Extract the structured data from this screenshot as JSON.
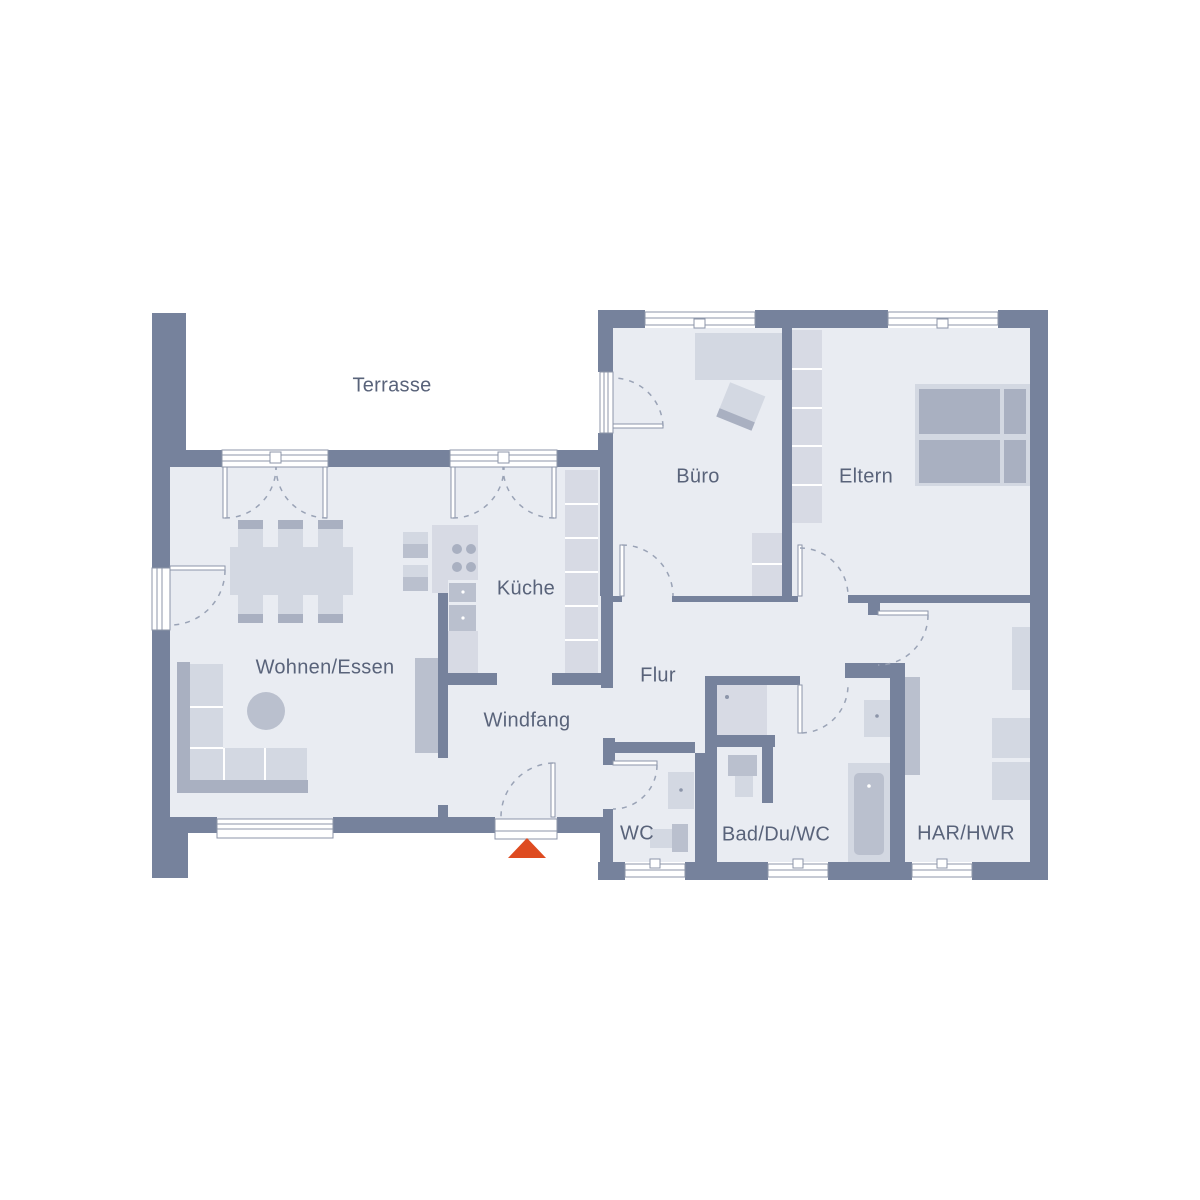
{
  "colors": {
    "background": "#FFFFFF",
    "wall": "#76829C",
    "floor": "#E9ECF2",
    "furniture_light": "#D3D8E2",
    "furniture_medium": "#BAC0CE",
    "furniture_dark": "#A9B0C1",
    "cabinet": "#D7DAE4",
    "frame": "#8C95A9",
    "swing_arc": "#9AA3B6",
    "label_text": "#59637A",
    "entrance_arrow": "#DE4B20"
  },
  "rooms": {
    "terrasse": {
      "label": "Terrasse"
    },
    "buero": {
      "label": "Büro"
    },
    "eltern": {
      "label": "Eltern"
    },
    "kueche": {
      "label": "Küche"
    },
    "wohnen_essen": {
      "label": "Wohnen/Essen"
    },
    "flur": {
      "label": "Flur"
    },
    "windfang": {
      "label": "Windfang"
    },
    "wc": {
      "label": "WC"
    },
    "bad": {
      "label": "Bad/Du/WC"
    },
    "har_hwr": {
      "label": "HAR/HWR"
    }
  },
  "entrance": {
    "symbol": "triangle-arrow-up"
  }
}
